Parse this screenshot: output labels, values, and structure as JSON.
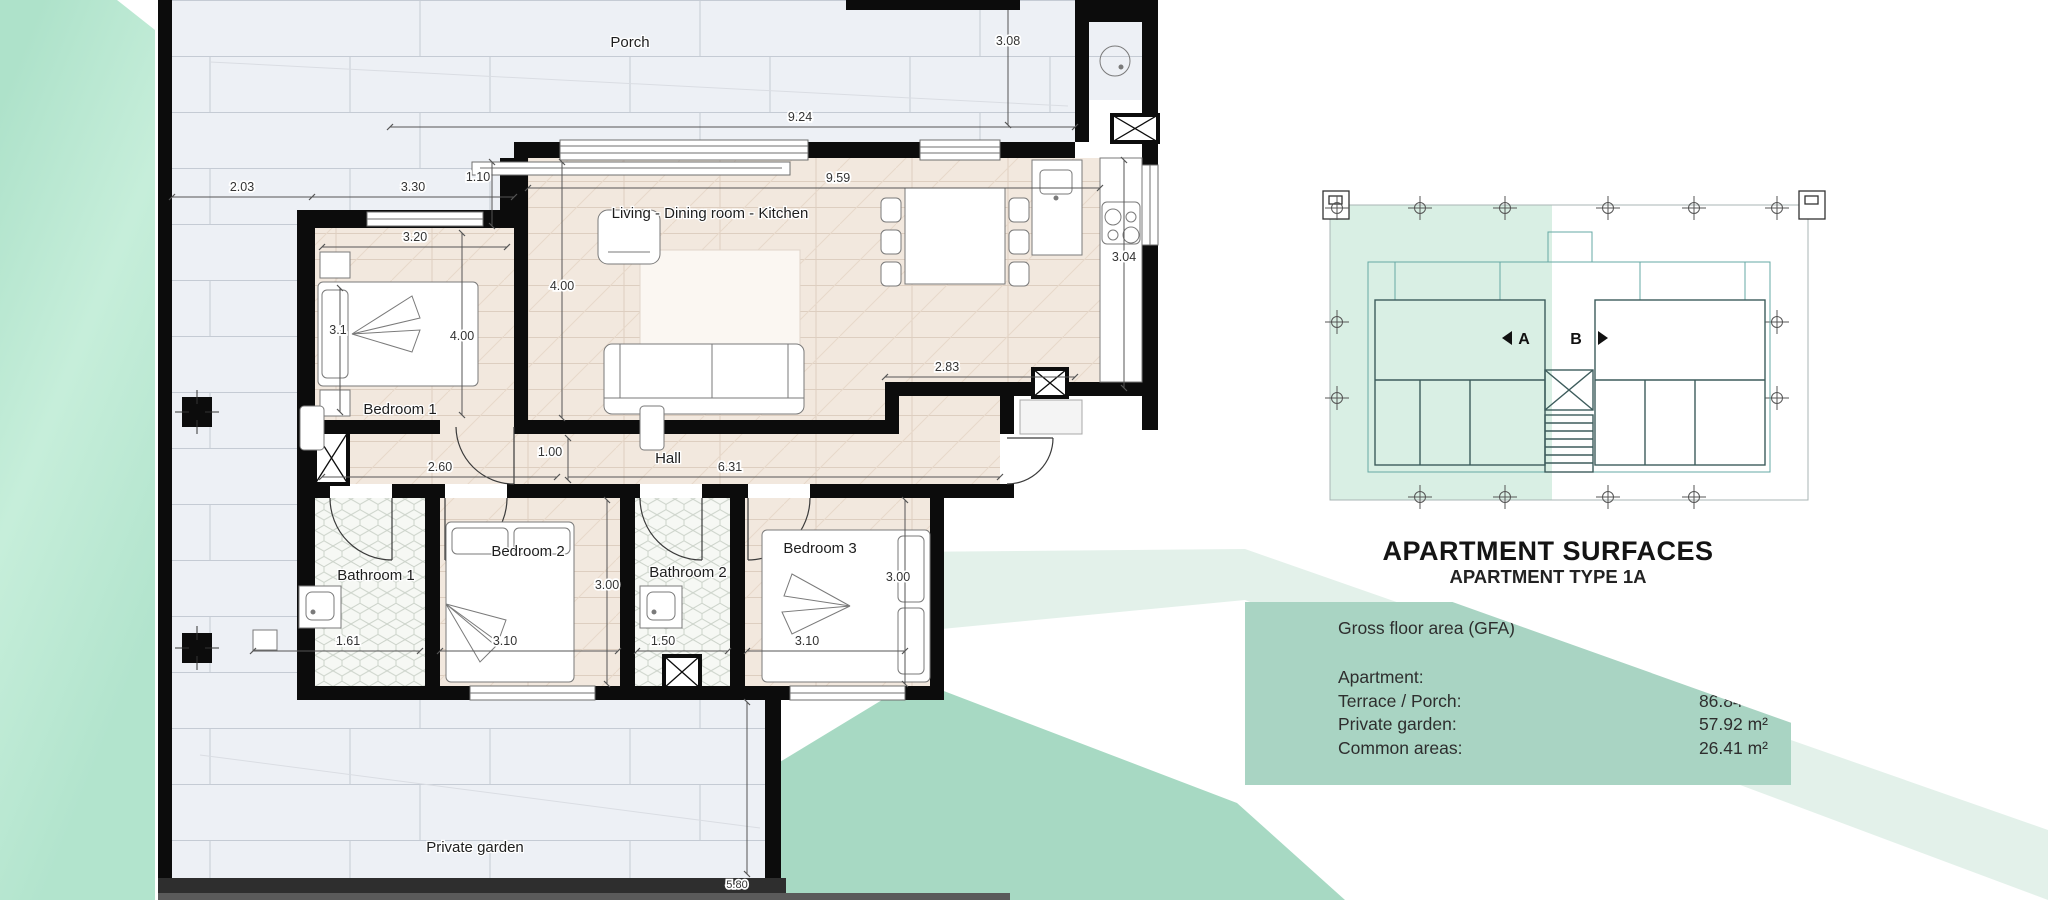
{
  "floor_plan": {
    "rooms": {
      "porch": "Porch",
      "living": "Living - Dining room - Kitchen",
      "bedroom1": "Bedroom 1",
      "hall": "Hall",
      "bathroom1": "Bathroom 1",
      "bedroom2": "Bedroom 2",
      "bathroom2": "Bathroom 2",
      "bedroom3": "Bedroom 3",
      "garden": "Private garden"
    },
    "dimensions": {
      "terrace_width": "2.03",
      "bedroom1_front": "3.30",
      "step": "1.10",
      "porch_width": "9.24",
      "porch_depth": "3.08",
      "living_length": "9.59",
      "living_depth": "4.00",
      "bedroom1_width": "3.20",
      "bedroom1_side": "3.1",
      "bedroom1_depth": "4.00",
      "hall_left": "2.60",
      "hall_width": "1.00",
      "hall_length": "6.31",
      "bedroom2_depth": "3.00",
      "bathroom1_width": "1.61",
      "bedroom2_width": "3.10",
      "bathroom2_width": "1.50",
      "bedroom3_width": "3.10",
      "bedroom3_depth": "3.00",
      "kitchen_terrace": "2.83",
      "kitchen_depth": "3.04",
      "garden_depth": "5.80"
    }
  },
  "key_plan": {
    "unit_a": "A",
    "unit_b": "B"
  },
  "surfaces_panel": {
    "title": "APARTMENT SURFACES",
    "subtitle": "APARTMENT TYPE 1A",
    "heading": "Gross floor area (GFA)",
    "rows": [
      {
        "label": "Apartment:",
        "value": "97.47 m²"
      },
      {
        "label": "Terrace / Porch:",
        "value": "86.84 m²"
      },
      {
        "label": "Private garden:",
        "value": "57.92 m²"
      },
      {
        "label": "Common areas:",
        "value": "26.41 m²"
      }
    ]
  },
  "colors": {
    "panel_green": "#a9d4c3",
    "wedge_green": "#b7e5d1",
    "pale_band": "#e3f1ea",
    "medium_band": "#a7d9c3",
    "key_plan_highlight": "#d9efe4",
    "wall_black": "#0c0c0c",
    "tile_fill": "#edf0f5",
    "wood_fill": "#f2e8de"
  }
}
